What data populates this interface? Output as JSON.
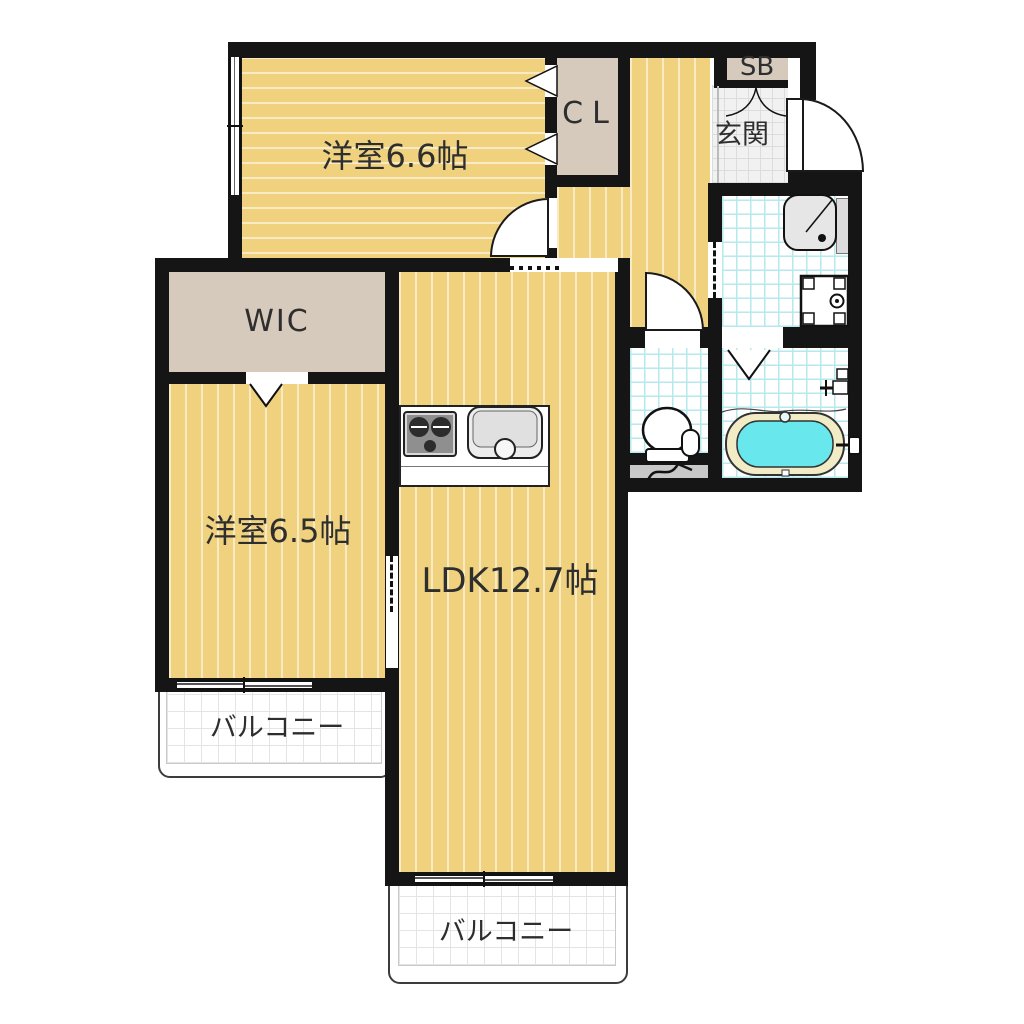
{
  "plan": {
    "unit_labels": {
      "western_room_1": "洋室6.6帖",
      "closet": "CL",
      "shoe_box": "SB",
      "entrance": "玄関",
      "wic": "WIC",
      "western_room_2": "洋室6.5帖",
      "ldk": "LDK12.7帖",
      "balcony_left": "バルコニー",
      "balcony_bottom": "バルコニー"
    },
    "fixtures": [
      "kitchen-stove",
      "kitchen-sink",
      "washbasin",
      "washing-machine-pan",
      "toilet",
      "bathtub",
      "shower-mixer",
      "pipe-space",
      "entrance-door",
      "shoe-box-doors",
      "folding-bath-door",
      "sliding-door-washroom",
      "sliding-door-room2-ldk"
    ],
    "colors": {
      "floor_yellow": "#EFD17E",
      "closet_beige": "#D5CABC",
      "wall_black": "#151515",
      "tile_line_cyan": "#B5E9EB",
      "entrance_tile_bg": "#F1F1F1",
      "entrance_tile_line": "#DCDCDC",
      "bath_water_cyan": "#68E8EC",
      "bathtub_rim_cream": "#F2ECC6",
      "balcony_grid_line": "#E4E4E4",
      "pipe_space_gray": "#C8C8C8",
      "fixture_gray": "#E6E6E6"
    }
  }
}
